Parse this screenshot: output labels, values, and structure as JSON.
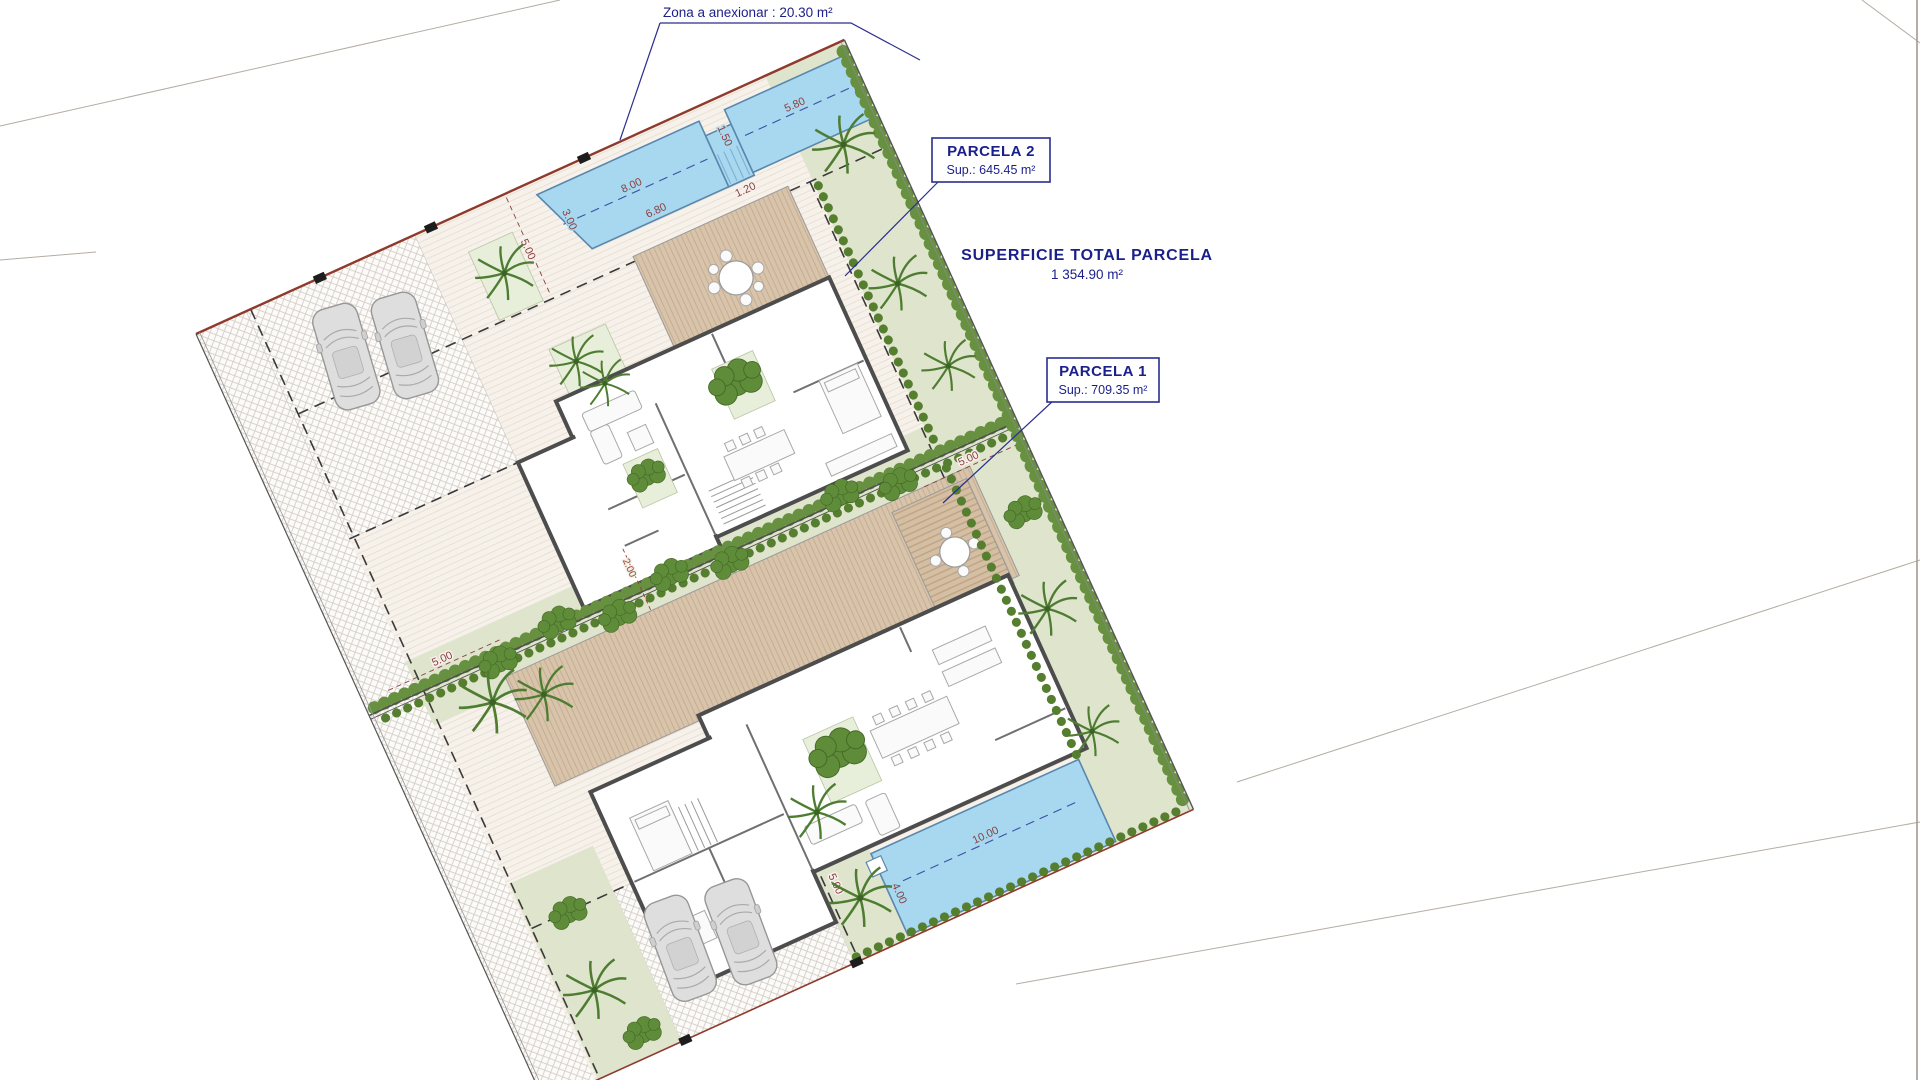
{
  "plan": {
    "callouts": {
      "zona_anexionar": "Zona a anexionar : 20.30 m²",
      "parcela2_title": "PARCELA 2",
      "parcela2_sup": "Sup.: 645.45 m²",
      "superficie_title": "SUPERFICIE TOTAL PARCELA",
      "superficie_value": "1 354.90 m²",
      "parcela1_title": "PARCELA 1",
      "parcela1_sup": "Sup.: 709.35 m²"
    },
    "dimensions": {
      "setback_top": "5.00",
      "setback_divider": "5.00",
      "setback_right": "5.00",
      "setback_driveway": "5.00",
      "fence_offset_a": "2.00",
      "fence_offset_b": "1.80",
      "pool2_top": "8.00",
      "pool2_bottom": "6.80",
      "pool2_left": "3.00",
      "pool2_neck": "1.50",
      "pool2_steps": "1.20",
      "pool2_right_top": "5.80",
      "pool2_right_side": "3.00",
      "pool1_length": "10.00",
      "pool1_width": "4.00"
    },
    "colors": {
      "label_navy": "#1b1f8a",
      "dimension_red": "#8a4040",
      "pool_blue": "#a8d8ef",
      "lawn_green": "#dfe5cd",
      "hedge_green": "#679140",
      "terrace_tan": "#d8c4ab",
      "boundary_red": "#8f3a2c",
      "ground_cream": "#f6f1ea"
    }
  }
}
